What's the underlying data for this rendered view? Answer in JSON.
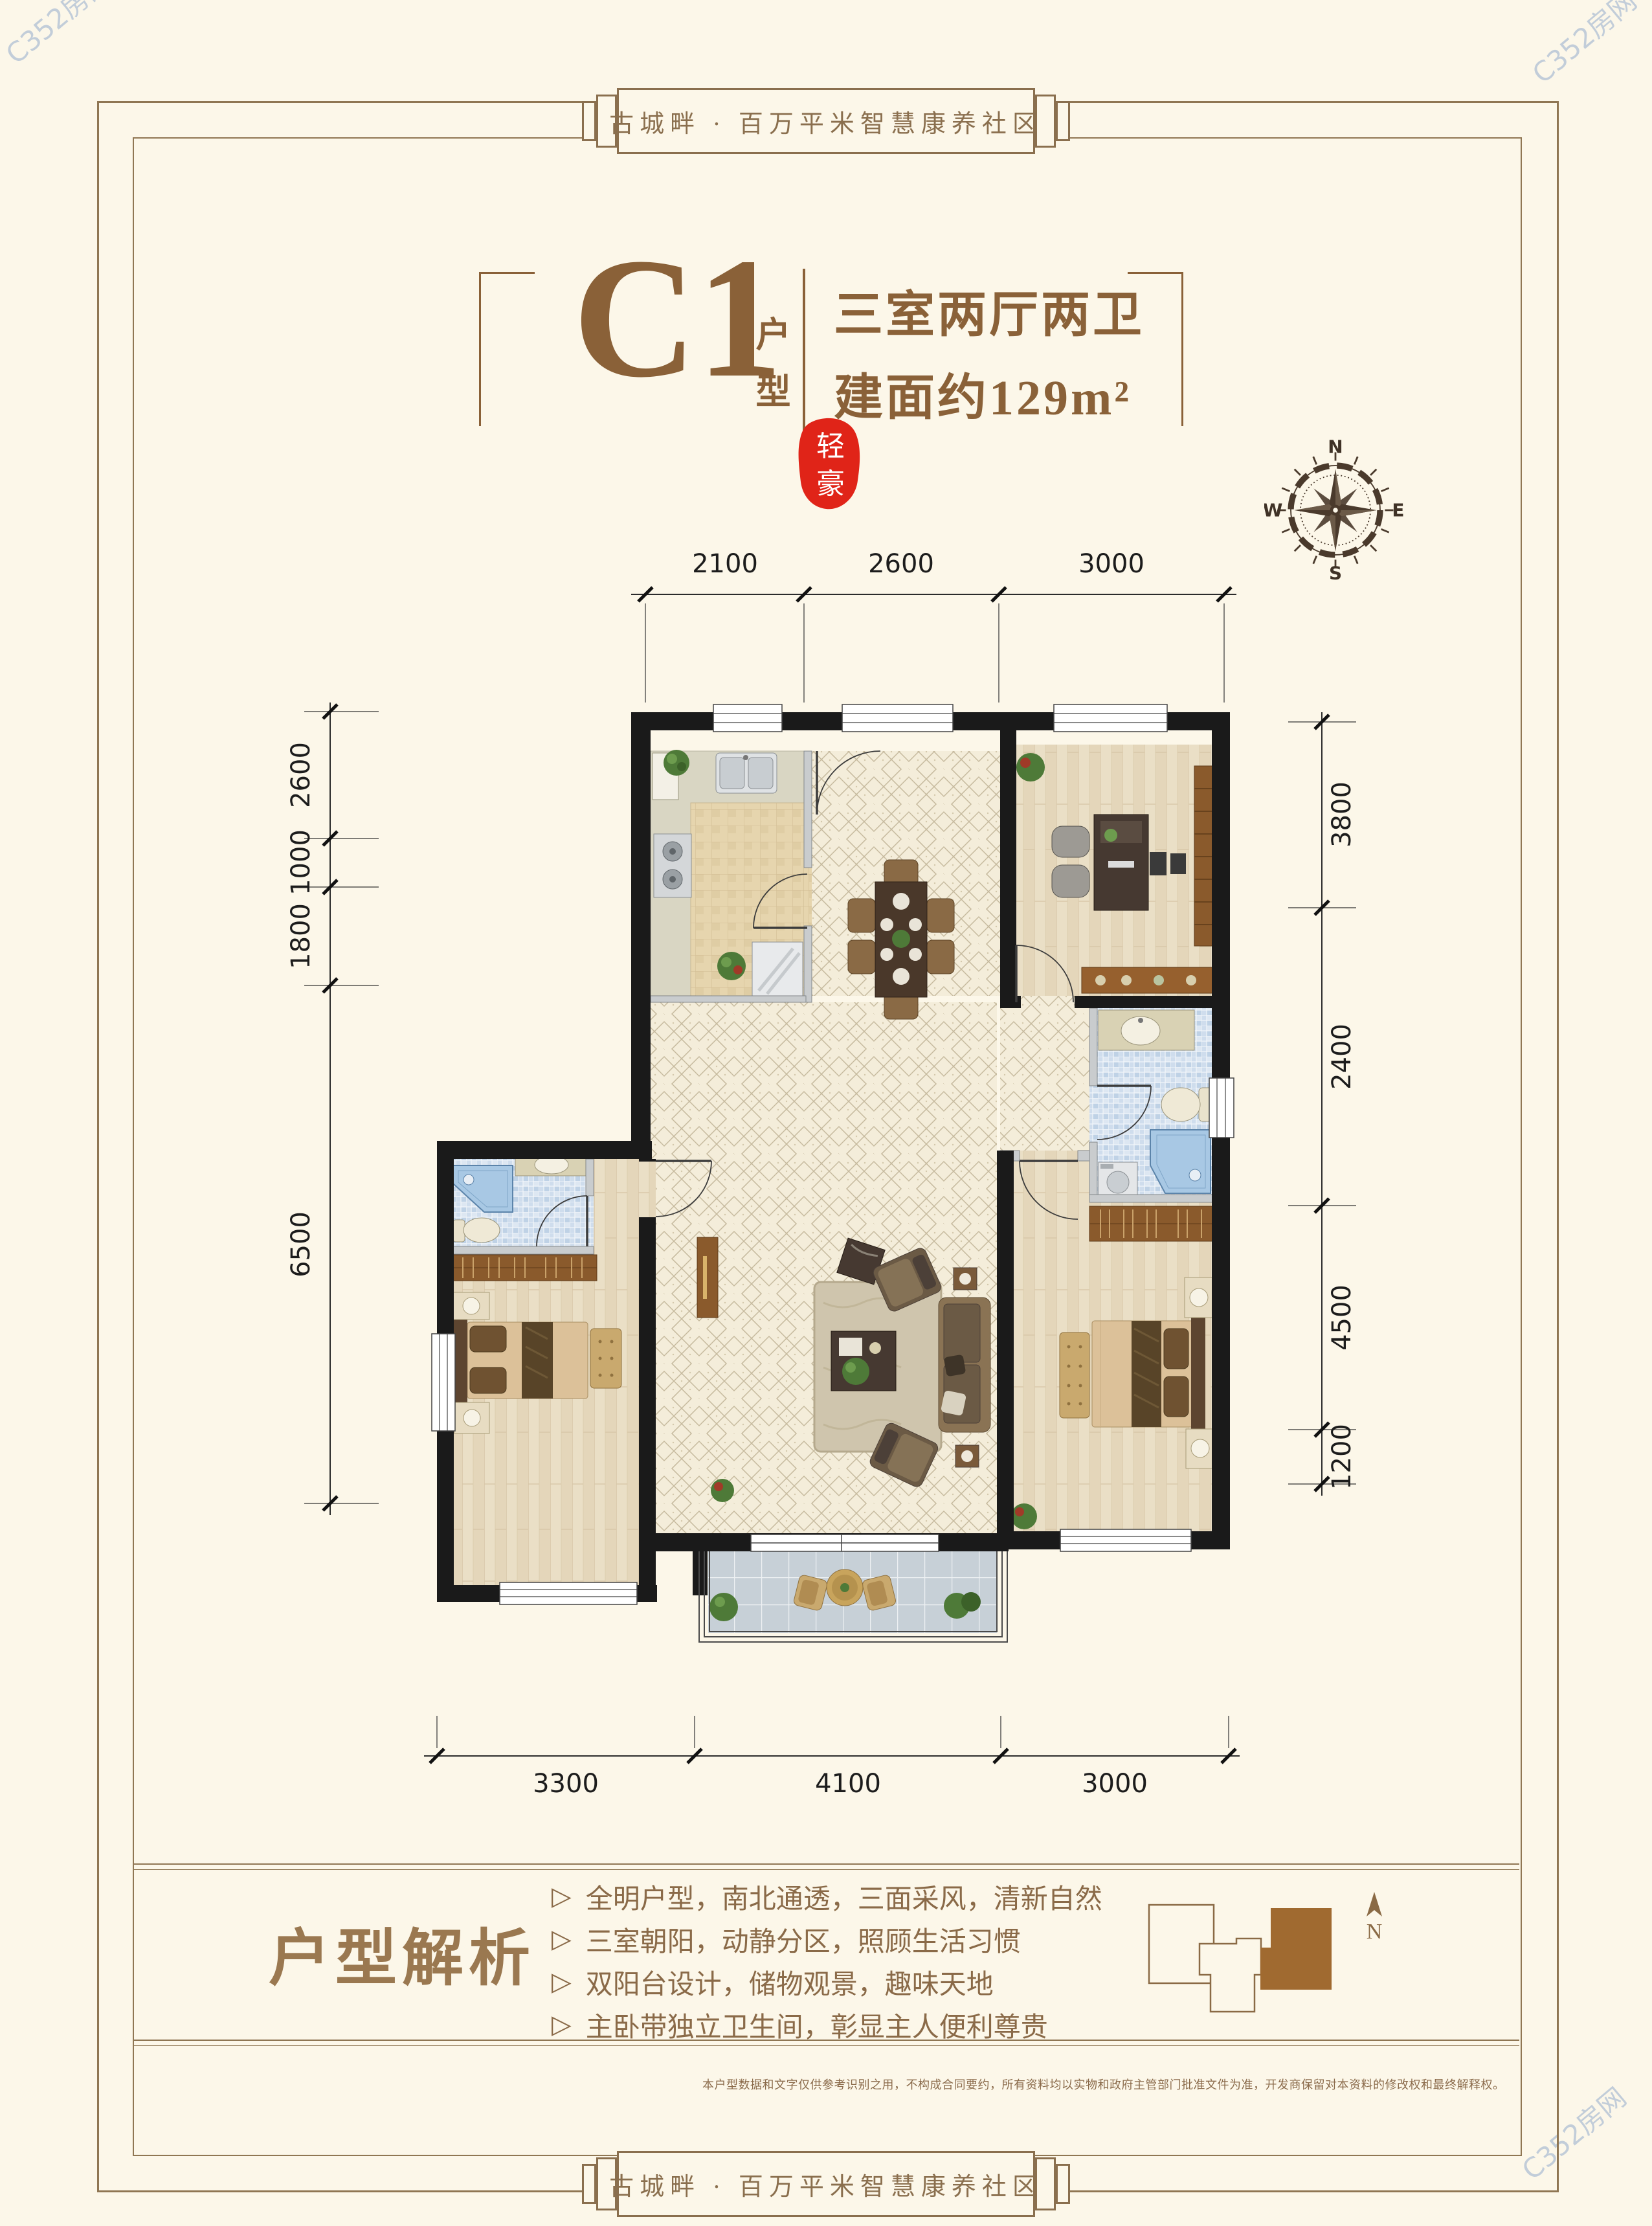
{
  "banner": {
    "text": "古城畔 · 百万平米智慧康养社区"
  },
  "title": {
    "code": "C1",
    "code_label": "户型",
    "spec": "三室两厅两卫",
    "area": "建面约129m²"
  },
  "seal": {
    "char1": "轻",
    "char2": "豪"
  },
  "compass": {
    "n": "N",
    "e": "E",
    "s": "S",
    "w": "W"
  },
  "dims": {
    "top": [
      "2100",
      "2600",
      "3000"
    ],
    "left": [
      "2600",
      "1000",
      "1800",
      "6500"
    ],
    "right": [
      "3800",
      "2400",
      "4500",
      "1200"
    ],
    "bottom": [
      "3300",
      "4100",
      "3000"
    ]
  },
  "analysis": {
    "title": "户型解析",
    "marker": "▷",
    "bullets": [
      "全明户型，南北通透，三面采风，清新自然",
      "三室朝阳，动静分区，照顾生活习惯",
      "双阳台设计，储物观景，趣味天地",
      "主卧带独立卫生间，彰显主人便利尊贵"
    ]
  },
  "keyplan": {
    "north": "N"
  },
  "disclaimer": "本户型数据和文字仅供参考识别之用，不构成合同要约，所有资料均以实物和政府主管部门批准文件为准，开发商保留对本资料的修改权和最终解释权。",
  "watermark": "C352房网",
  "colors": {
    "accent": "#8a6138",
    "seal_red": "#e02418",
    "frame": "#8f7653",
    "wall": "#1a1a1a"
  }
}
